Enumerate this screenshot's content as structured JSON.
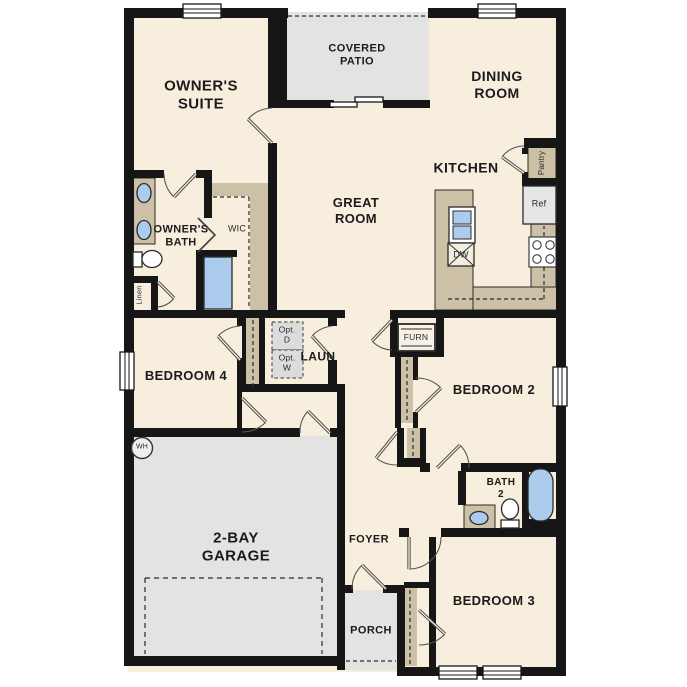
{
  "plan_title": "Single-story floor plan",
  "rooms": {
    "owners_suite": {
      "label": "OWNER'S\nSUITE"
    },
    "covered_patio": {
      "label": "COVERED\nPATIO"
    },
    "dining_room": {
      "label": "DINING\nROOM"
    },
    "kitchen": {
      "label": "KITCHEN"
    },
    "great_room": {
      "label": "GREAT\nROOM"
    },
    "owners_bath": {
      "label": "OWNER'S\nBATH"
    },
    "wic": {
      "label": "WIC"
    },
    "bedroom_4": {
      "label": "BEDROOM 4"
    },
    "laundry": {
      "label": "LAUN"
    },
    "bedroom_2": {
      "label": "BEDROOM 2"
    },
    "garage": {
      "label": "2-BAY\nGARAGE"
    },
    "foyer": {
      "label": "FOYER"
    },
    "bath_2": {
      "label": "BATH\n2"
    },
    "bedroom_3": {
      "label": "BEDROOM 3"
    },
    "porch": {
      "label": "PORCH"
    }
  },
  "fixtures": {
    "pantry": {
      "label": "Pantry"
    },
    "refrigerator": {
      "label": "Ref"
    },
    "dishwasher": {
      "label": "DW"
    },
    "linen": {
      "label": "Linen"
    },
    "optional_dryer": {
      "label": "Opt.\nD"
    },
    "optional_washer": {
      "label": "Opt.\nW"
    },
    "furnace": {
      "label": "FURN"
    },
    "water_heater": {
      "label": "WH"
    }
  },
  "colors": {
    "wall": "#161616",
    "floor": "#f7eede",
    "concrete_gray": "#e3e3e1",
    "cabinet_tan": "#ccc0a6",
    "fixture_blue": "#abccec",
    "option_box_gray": "#dcdcdc",
    "door_swing": "#555555",
    "text": "#1b1b1b"
  }
}
